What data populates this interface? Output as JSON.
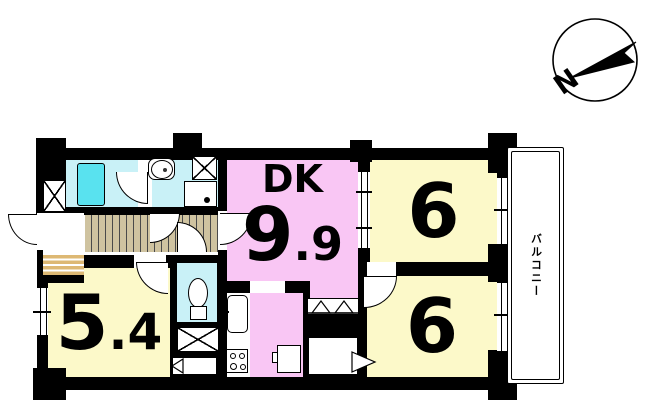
{
  "compass": {
    "north_label": "N"
  },
  "rooms": {
    "dk": {
      "label": "DK",
      "area_int": "9",
      "area_frac": ".9"
    },
    "bedroom_top_right": {
      "area": "6"
    },
    "bedroom_bottom_right": {
      "area": "6"
    },
    "bedroom_left": {
      "area_int": "5",
      "area_frac": ".4"
    },
    "balcony": {
      "label": "バルコニー"
    }
  },
  "colors": {
    "wall": "#000000",
    "dk_pink": "#f9c6f4",
    "bedroom_yellow": "#fcf9c9",
    "wet_area_cyan": "#c9f1f7",
    "bathtub_cyan": "#59e2ef",
    "corridor_wood": "#cfc3a0",
    "entry_step": "#ddb873"
  }
}
